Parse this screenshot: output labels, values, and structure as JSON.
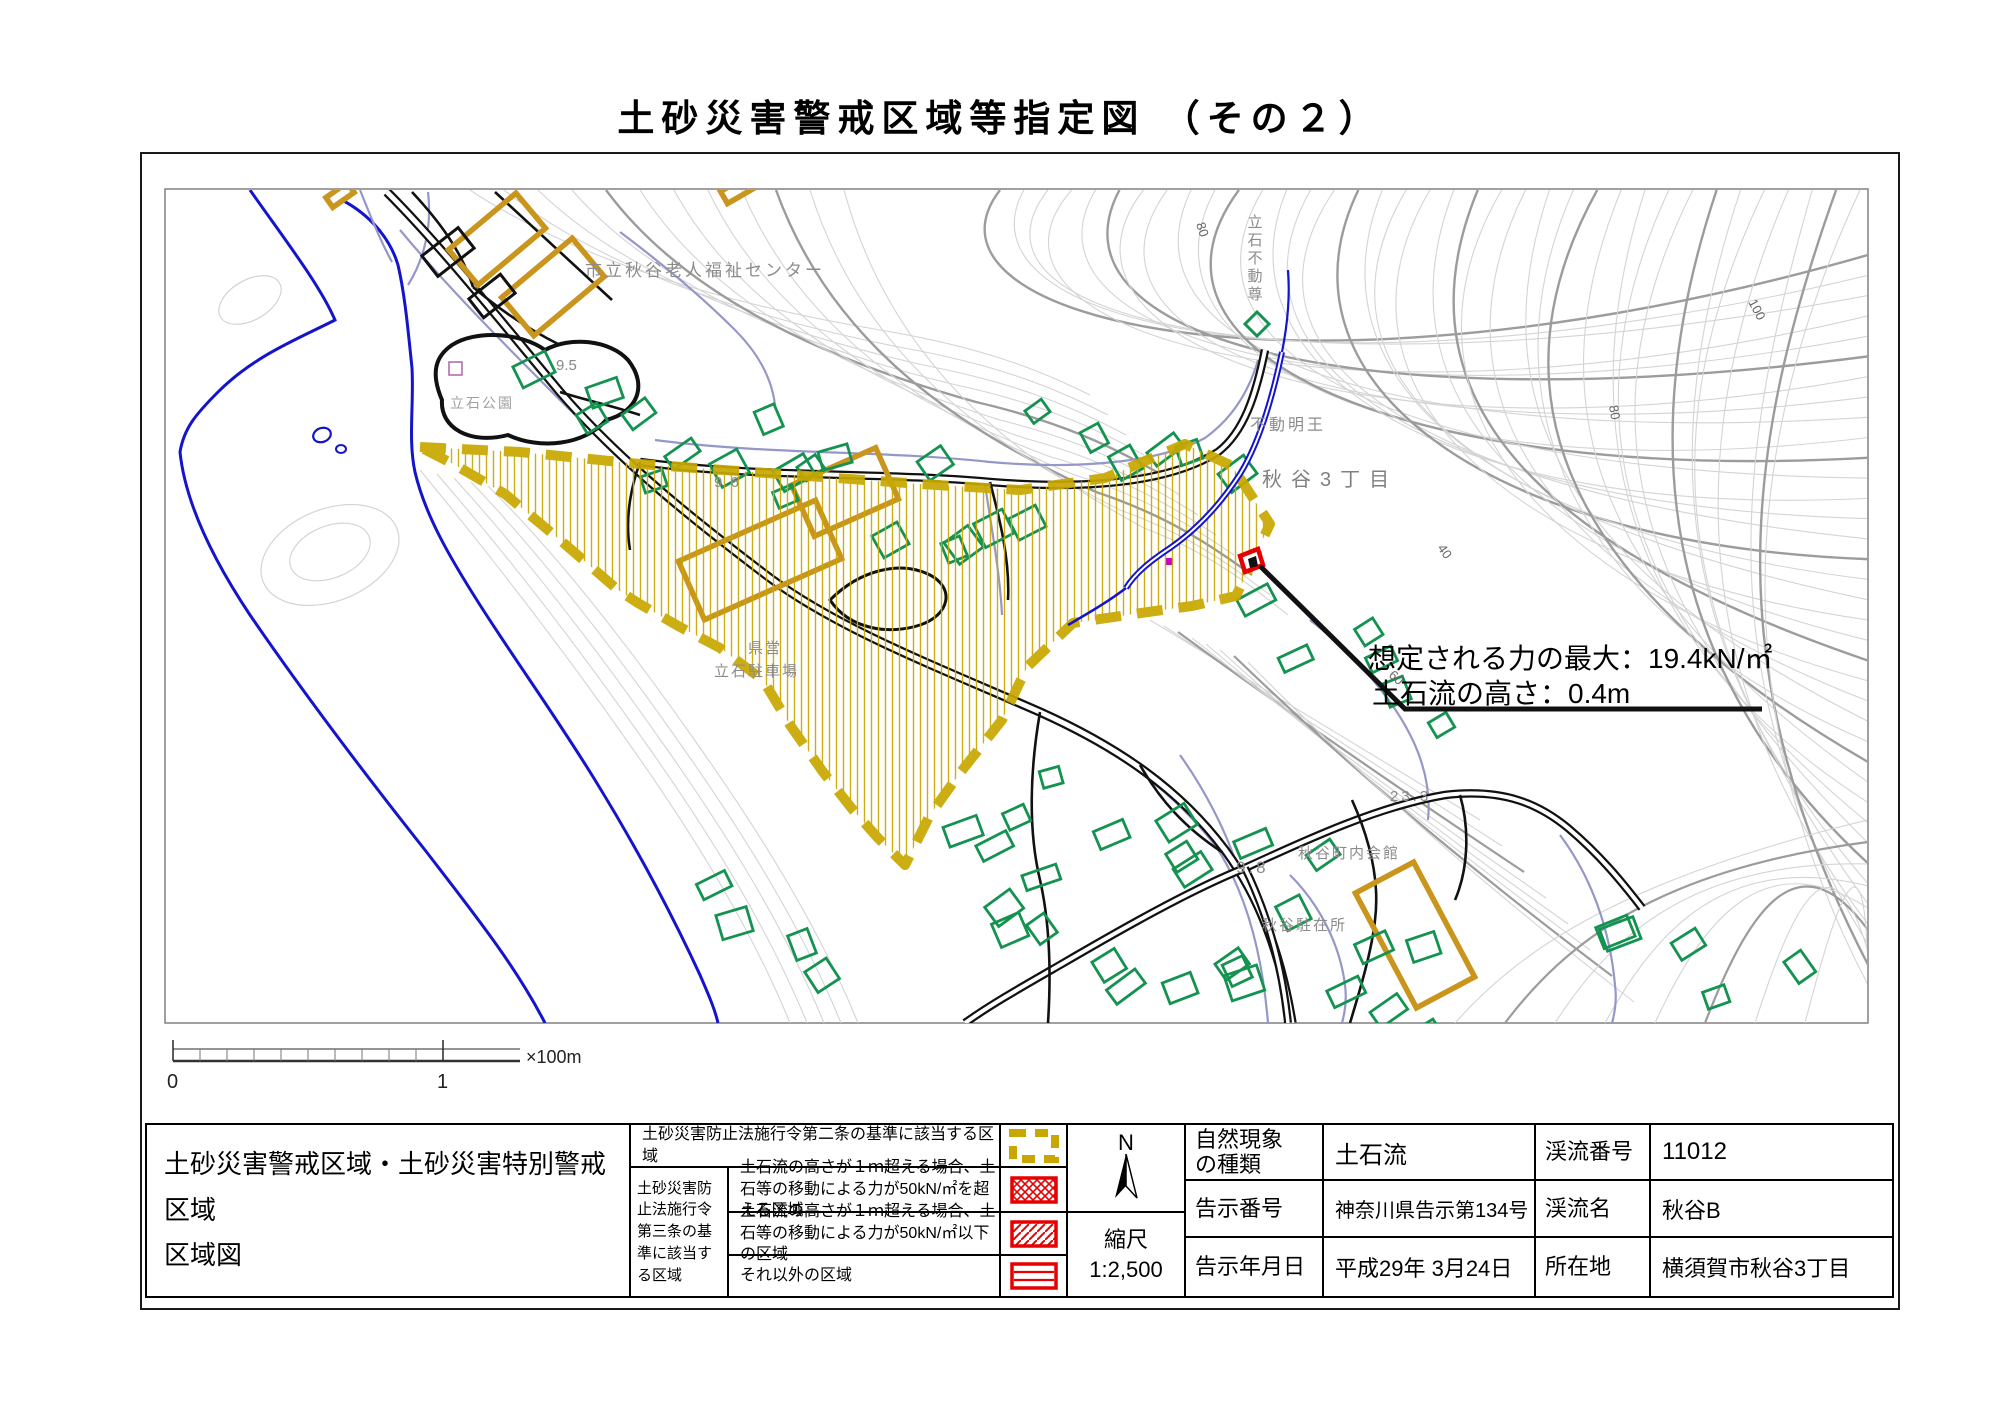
{
  "title": "土砂災害警戒区域等指定図 （その２）",
  "colors": {
    "hazard_yellow": "#c8a800",
    "special_red": "#e60000",
    "building_green": "#149250",
    "building_orange": "#c9951c",
    "water_blue": "#1414cc",
    "contour_gray": "#9c9c9c"
  },
  "map": {
    "labels": {
      "welfare_center": "市立秋谷老人福祉センター",
      "tateishi_park": "立石公園",
      "tateishi_fudoson": "立石不動尊",
      "fudo_myoo": "不動明王",
      "akiya_3chome": "秋谷3丁目",
      "kenei": "県営",
      "tateishi_parking": "立石駐車場",
      "chonaikaikan": "秋谷町内会館",
      "chuzaisho": "秋谷駐在所",
      "spot_95": "9.5",
      "spot_96": "9.6",
      "spot_98": "9.8",
      "spot_233": "23.3",
      "contour_100": "100",
      "contour_80a": "80",
      "contour_80b": "80",
      "contour_60": "60",
      "contour_40": "40"
    },
    "annotation": {
      "line1": "想定される力の最大：19.4kN/㎡",
      "line2": "土石流の高さ：0.4m"
    }
  },
  "scalebar": {
    "tick0": "0",
    "tick1": "1",
    "unit": "×100m"
  },
  "legend": {
    "map_title_line1": "土砂災害警戒区域・土砂災害特別警戒区域",
    "map_title_line2": "区域図",
    "row1_text": "土砂災害防止法施行令第二条の基準に該当する区域",
    "group_label": "土砂災害防止法施行令第三条の基準に該当する区域",
    "row2_text": "土石流の高さが１ｍ超える場合、土石等の移動による力が50kN/㎡を超える区域",
    "row3_text": "土石流の高さが１ｍ超える場合、土石等の移動による力が50kN/㎡以下の区域",
    "row4_text": "それ以外の区域"
  },
  "compass": {
    "north": "N",
    "scale_label": "縮尺",
    "scale_value": "1:2,500"
  },
  "info": {
    "rows": [
      {
        "label": "自然現象\nの種類",
        "value": "土石流",
        "label2": "渓流番号",
        "value2": "11012"
      },
      {
        "label": "告示番号",
        "value": "神奈川県告示第134号",
        "label2": "渓流名",
        "value2": "秋谷B"
      },
      {
        "label": "告示年月日",
        "value": "平成29年 3月24日",
        "label2": "所在地",
        "value2": "横須賀市秋谷3丁目"
      }
    ]
  }
}
